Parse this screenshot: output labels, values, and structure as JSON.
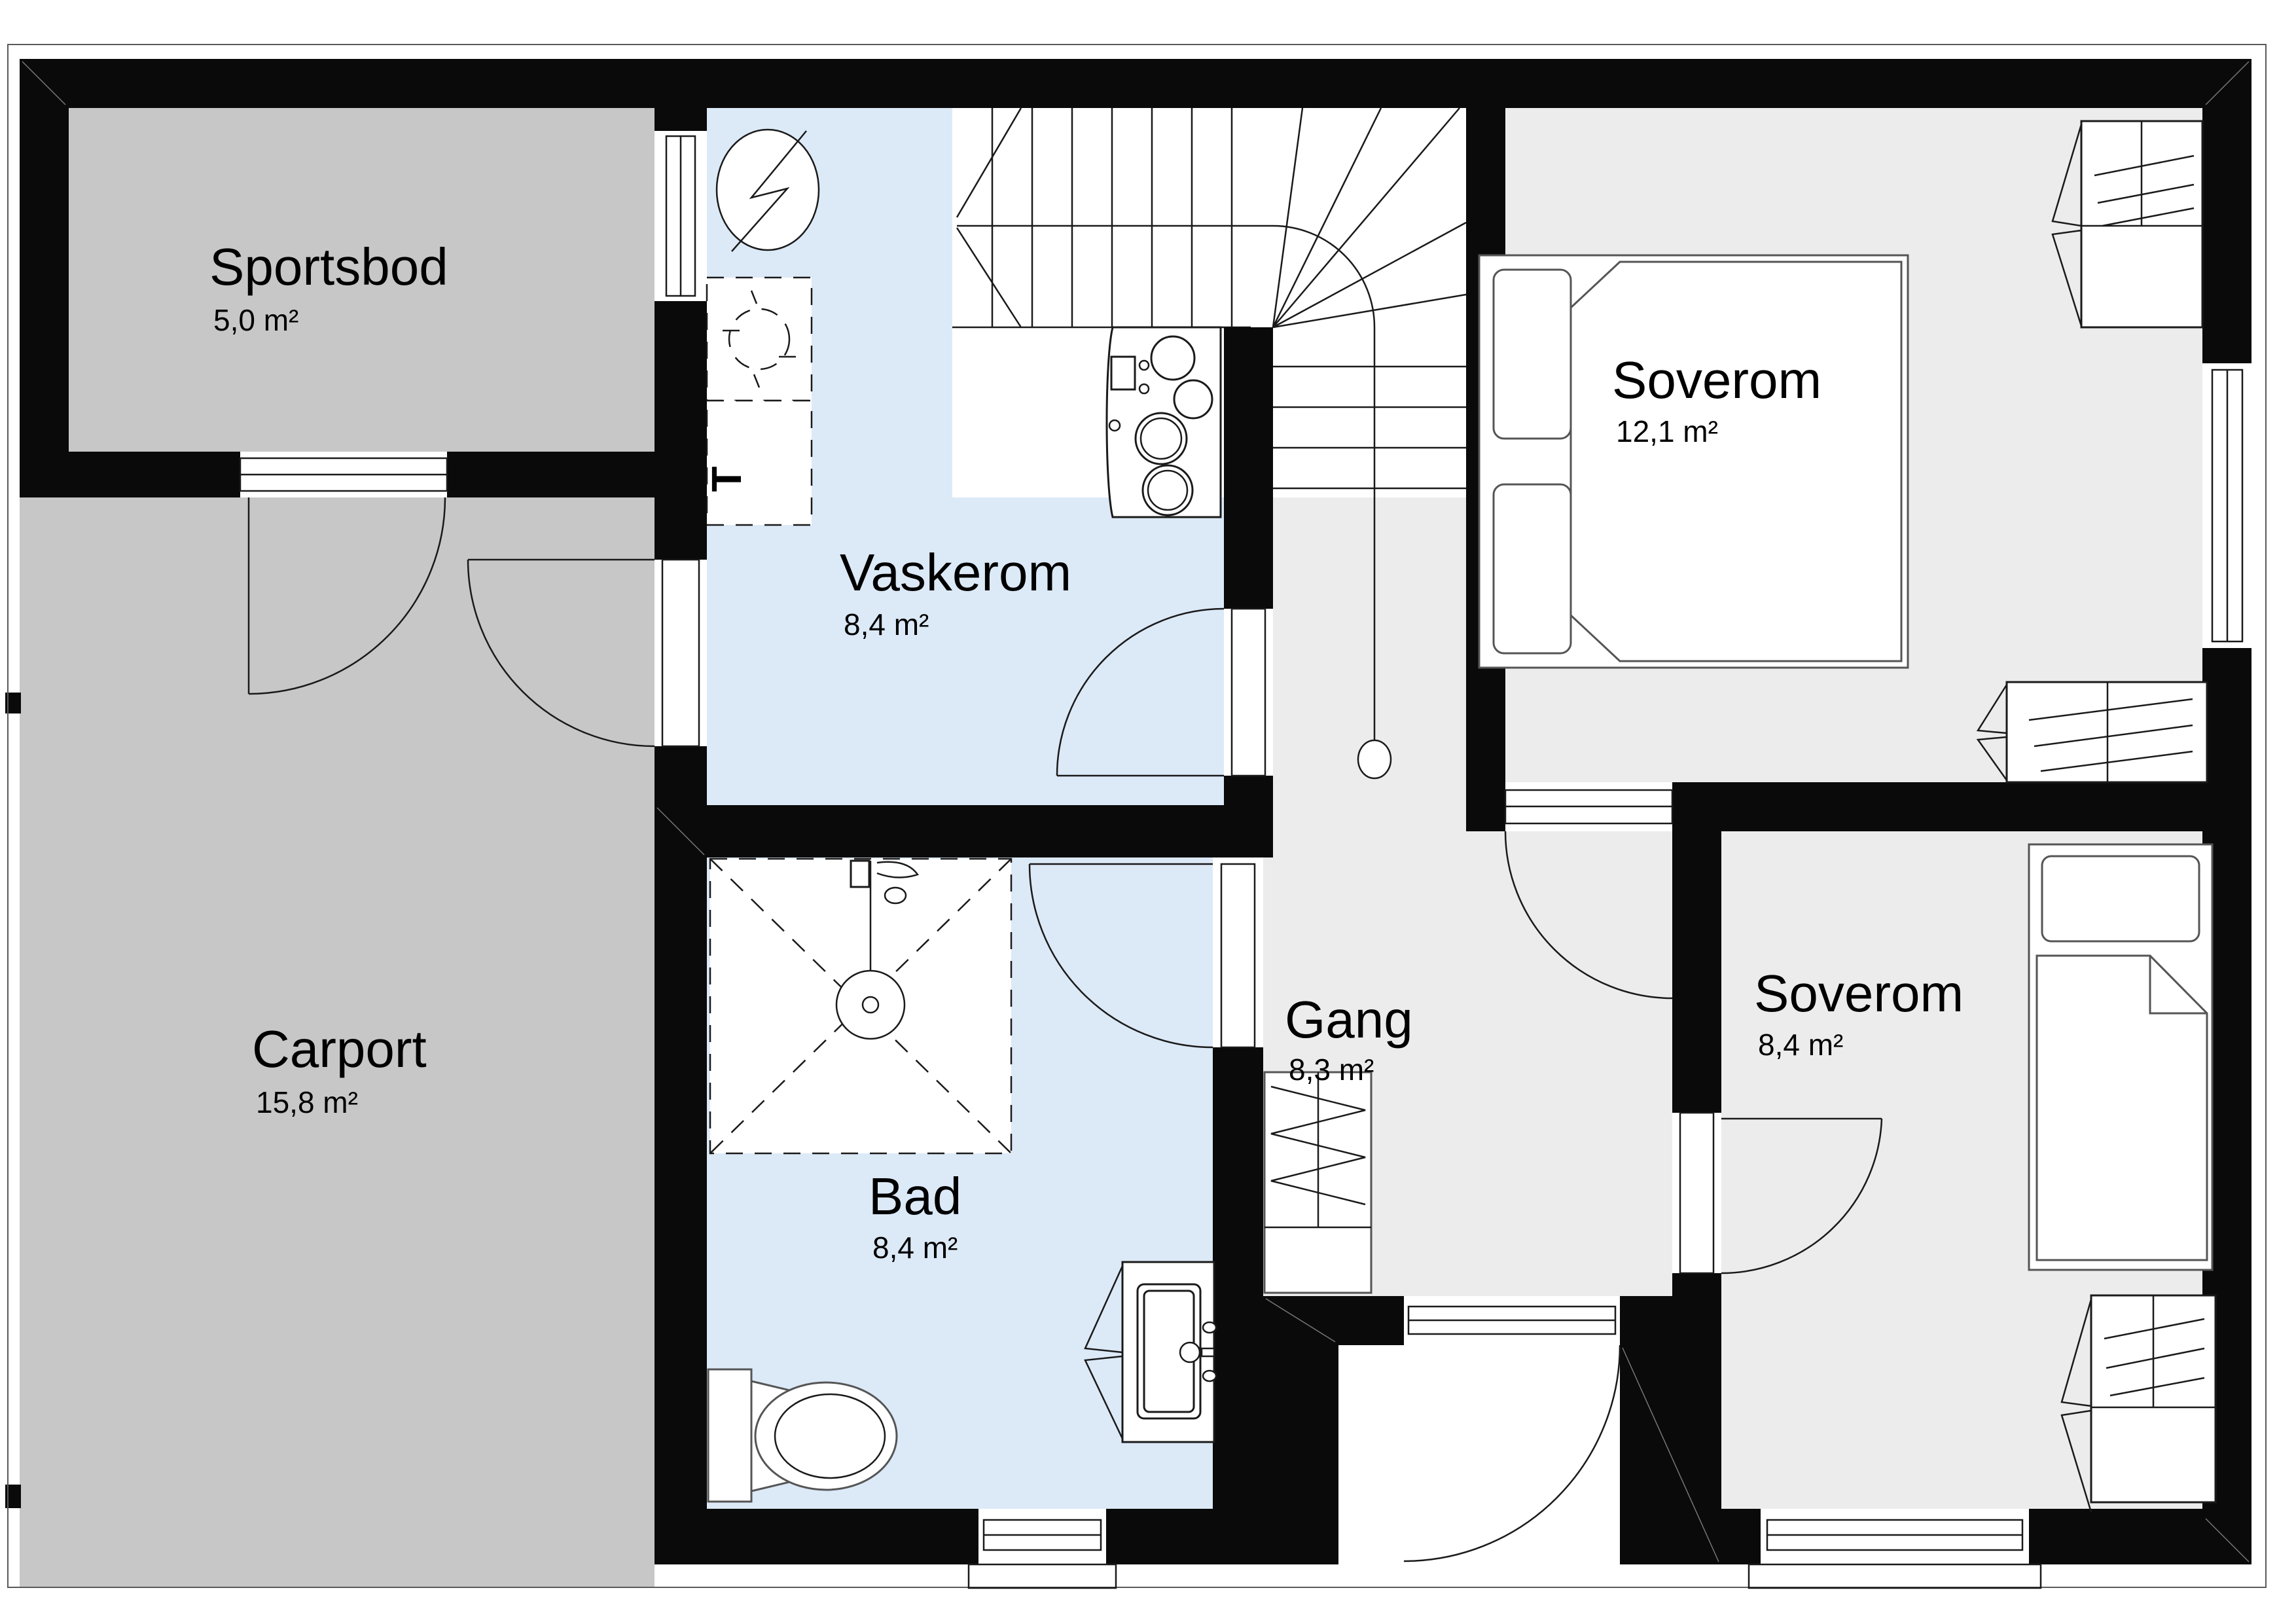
{
  "plan": {
    "type": "floor-plan",
    "language": "Norwegian",
    "rooms": [
      {
        "id": "sportsbod",
        "name": "Sportsbod",
        "area": "5,0 m²",
        "fill": "#c7c7c7"
      },
      {
        "id": "carport",
        "name": "Carport",
        "area": "15,8 m²",
        "fill": "#c7c7c7"
      },
      {
        "id": "vaskerom",
        "name": "Vaskerom",
        "area": "8,4 m²",
        "fill": "#dce9f7"
      },
      {
        "id": "bad",
        "name": "Bad",
        "area": "8,4 m²",
        "fill": "#dce9f7"
      },
      {
        "id": "gang",
        "name": "Gang",
        "area": "8,3 m²",
        "fill": "#ececec"
      },
      {
        "id": "soverom-stor",
        "name": "Soverom",
        "area": "12,1 m²",
        "fill": "#ececec"
      },
      {
        "id": "soverom-liten",
        "name": "Soverom",
        "area": "8,4 m²",
        "fill": "#ececec"
      }
    ],
    "symbols": {
      "dryer_label": "T",
      "electrical_panel": "circle-lightning-icon",
      "stair_start_marker": "circle"
    },
    "colors": {
      "wall": "#0a0a0a",
      "storage_floor": "#c7c7c7",
      "wet_room_floor": "#dce9f7",
      "dry_room_floor": "#ececec",
      "background": "#ffffff"
    }
  }
}
